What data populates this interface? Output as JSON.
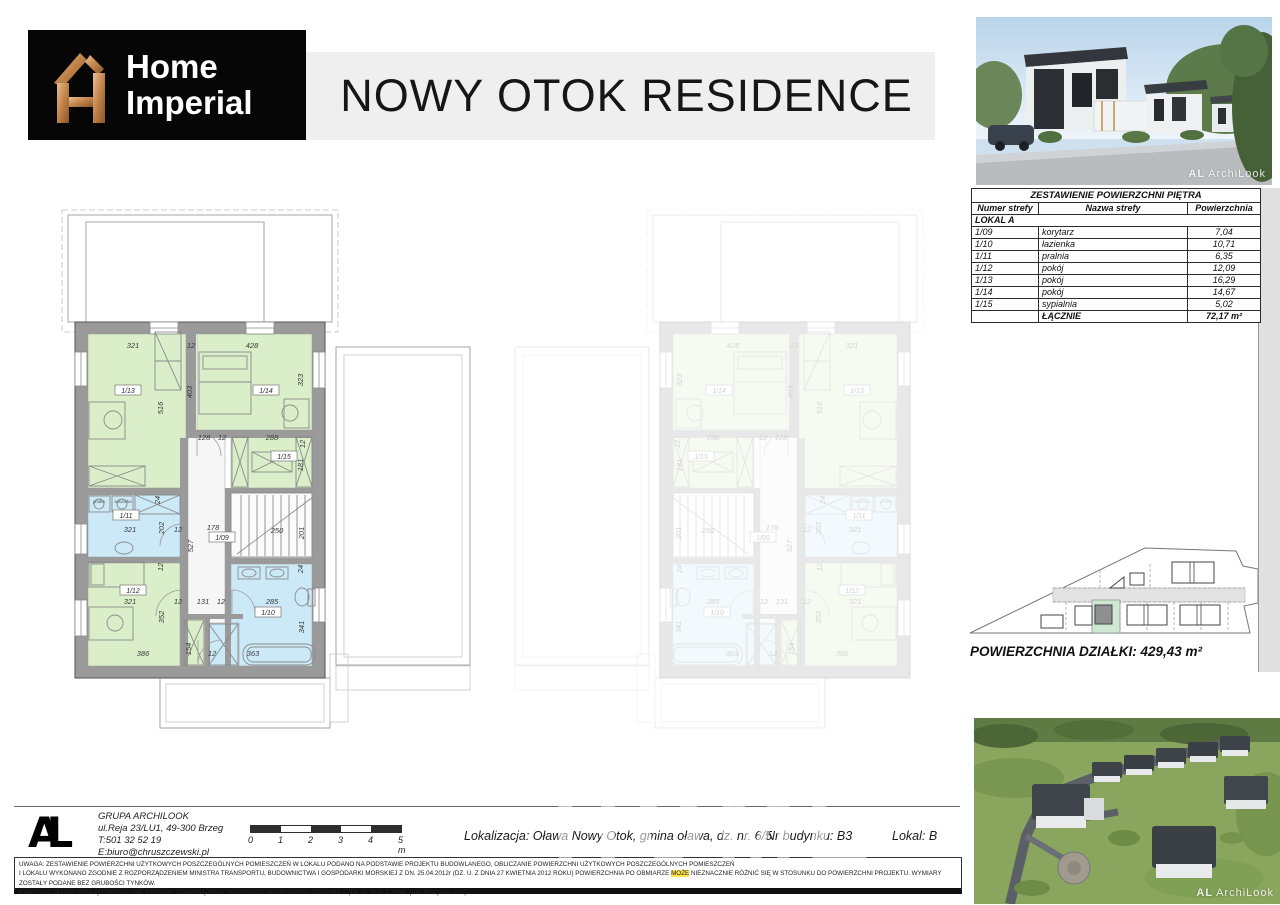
{
  "header": {
    "logo_line1": "Home",
    "logo_line2": "Imperial",
    "title": "NOWY OTOK RESIDENCE"
  },
  "photos": {
    "top_watermark_mark": "AL",
    "top_watermark_text": "ArchiLook",
    "bottom_watermark_mark": "AL",
    "bottom_watermark_text": "ArchiLook"
  },
  "area_table": {
    "title": "ZESTAWIENIE POWIERZCHNI PIĘTRA",
    "columns": [
      "Numer strefy",
      "Nazwa strefy",
      "Powierzchnia"
    ],
    "group_label": "LOKAL A",
    "rows": [
      [
        "1/09",
        "korytarz",
        "7,04"
      ],
      [
        "1/10",
        "łazienka",
        "10,71"
      ],
      [
        "1/11",
        "pralnia",
        "6,35"
      ],
      [
        "1/12",
        "pokój",
        "12,09"
      ],
      [
        "1/13",
        "pokój",
        "16,29"
      ],
      [
        "1/14",
        "pokój",
        "14,67"
      ],
      [
        "1/15",
        "sypialnia",
        "5,02"
      ]
    ],
    "total_label": "ŁĄCZNIE",
    "total_value": "72,17 m²"
  },
  "site_plan": {
    "area_label": "POWIERZCHNIA DZIAŁKI: 429,43 m²"
  },
  "floor_plan": {
    "rooms": [
      {
        "id": "1/13",
        "color": "green",
        "x": 88,
        "y": 334,
        "w": 98,
        "h": 154,
        "tx": 128,
        "ty": 392
      },
      {
        "id": "1/14",
        "color": "green",
        "x": 197,
        "y": 334,
        "w": 115,
        "h": 96,
        "tx": 266,
        "ty": 392
      },
      {
        "id": "1/15",
        "color": "green",
        "x": 231,
        "y": 436,
        "w": 81,
        "h": 52,
        "tx": 284,
        "ty": 458
      },
      {
        "id": "1/11",
        "color": "blue",
        "x": 88,
        "y": 495,
        "w": 92,
        "h": 62,
        "tx": 126,
        "ty": 517
      },
      {
        "id": "1/09",
        "color": "hall",
        "x": 188,
        "y": 436,
        "w": 37,
        "h": 230,
        "tx": 222,
        "ty": 539
      },
      {
        "id": "",
        "color": "hall2",
        "x": 231,
        "y": 493,
        "w": 81,
        "h": 65
      },
      {
        "id": "1/12",
        "color": "green",
        "x": 88,
        "y": 563,
        "w": 92,
        "h": 103,
        "tx": 133,
        "ty": 592
      },
      {
        "id": "1/10",
        "color": "blue",
        "x": 231,
        "y": 564,
        "w": 81,
        "h": 102,
        "tx": 268,
        "ty": 614
      },
      {
        "id": "",
        "color": "green",
        "x": 183,
        "y": 619,
        "w": 22,
        "h": 47
      },
      {
        "id": "",
        "color": "blue",
        "x": 209,
        "y": 623,
        "w": 30,
        "h": 43
      }
    ],
    "dims": [
      {
        "t": "321",
        "x": 133,
        "y": 348
      },
      {
        "t": "12",
        "x": 191,
        "y": 348
      },
      {
        "t": "428",
        "x": 252,
        "y": 348
      },
      {
        "t": "516",
        "x": 163,
        "y": 408,
        "v": 1
      },
      {
        "t": "403",
        "x": 192,
        "y": 392,
        "v": 1
      },
      {
        "t": "323",
        "x": 303,
        "y": 380,
        "v": 1
      },
      {
        "t": "128",
        "x": 204,
        "y": 440
      },
      {
        "t": "12",
        "x": 222,
        "y": 440
      },
      {
        "t": "288",
        "x": 272,
        "y": 440
      },
      {
        "t": "12",
        "x": 305,
        "y": 444,
        "v": 1
      },
      {
        "t": "181",
        "x": 303,
        "y": 465,
        "v": 1
      },
      {
        "t": "24",
        "x": 160,
        "y": 500,
        "v": 1
      },
      {
        "t": "321",
        "x": 130,
        "y": 532
      },
      {
        "t": "202",
        "x": 164,
        "y": 528,
        "v": 1
      },
      {
        "t": "12",
        "x": 178,
        "y": 532
      },
      {
        "t": "178",
        "x": 213,
        "y": 530
      },
      {
        "t": "527",
        "x": 193,
        "y": 546,
        "v": 1
      },
      {
        "t": "250",
        "x": 277,
        "y": 533
      },
      {
        "t": "201",
        "x": 304,
        "y": 533,
        "v": 1
      },
      {
        "t": "12",
        "x": 163,
        "y": 567,
        "v": 1
      },
      {
        "t": "24",
        "x": 303,
        "y": 569,
        "v": 1
      },
      {
        "t": "321",
        "x": 130,
        "y": 604
      },
      {
        "t": "352",
        "x": 164,
        "y": 617,
        "v": 1
      },
      {
        "t": "12",
        "x": 178,
        "y": 604
      },
      {
        "t": "131",
        "x": 203,
        "y": 604
      },
      {
        "t": "12",
        "x": 221,
        "y": 604
      },
      {
        "t": "285",
        "x": 272,
        "y": 604
      },
      {
        "t": "341",
        "x": 304,
        "y": 627,
        "v": 1
      },
      {
        "t": "386",
        "x": 143,
        "y": 656
      },
      {
        "t": "154",
        "x": 191,
        "y": 649,
        "v": 1
      },
      {
        "t": "12",
        "x": 212,
        "y": 656
      },
      {
        "t": "363",
        "x": 253,
        "y": 656
      }
    ],
    "appliances": [
      {
        "t": "pralka",
        "x": 99,
        "y": 503
      },
      {
        "t": "suszarka",
        "x": 123,
        "y": 503
      }
    ]
  },
  "footer": {
    "logo_mark": "AL",
    "company_name": "GRUPA ARCHILOOK",
    "company_address": "ul.Reja 23/LU1, 49-300 Brzeg",
    "company_phone": "T:501 32 52 19",
    "company_email": "E:biuro@chruszczewski.pl",
    "scale_ticks": [
      "0",
      "1",
      "2",
      "3",
      "4",
      "5 m"
    ],
    "location": "Lokalizacja: Oława Nowy Otok, gmina oława, dz. nr. 6/5",
    "building_no": "Nr budynku: B3",
    "unit": "Lokal: B"
  },
  "disclaimer": {
    "line1": "UWAGA: ZESTAWIENIE POWIERZCHNI UŻYTKOWYCH POSZCZEGÓLNYCH POMIESZCZEŃ W LOKALU PODANO NA PODSTAWIE PROJEKTU BUDOWLANEGO, OBLICZANIE POWIERZCHNI UŻYTKOWYCH POSZCZEGÓLNYCH POMIESZCZEŃ",
    "line2_pre": "I LOKALU WYKONANO ZGODNIE Z ROZPORZĄDZENIEM MINISTRA TRANSPORTU, BUDOWNICTWA I GOSPODARKI MORSKIEJ Z DN. 25.04.2012r (DZ. U. Z DNIA 27 KWIETNIA 2012 ROKU) POWIERZCHNIA PO OBMIARZE ",
    "line2_highlight": "MOŻE",
    "line2_post": " NIEZNACZNIE RÓŻNIĆ SIĘ W STOSUNKU DO POWIERZCHNI PROJEKTU. WYMIARY ZOSTAŁY PODANE BEZ GRUBOŚCI TYNKÓW.",
    "line3": "KARTA DO CELÓW POGLĄDOWYCH - NIE STANOWI ZOBOWIĄZANIA UMOWNEGO DEWELOPERA ZGODNIE Z (Dz. U. Nr16 Z 1964r. poz. 93 z późn. zm.)"
  },
  "watermark_ghost": "HOME",
  "colors": {
    "room_green": "#daeec9",
    "room_blue": "#cbe9f7",
    "wall_gray": "#9a9a9a",
    "highlight_parcel": "#cfe8d2",
    "logo_copper": "#c98e5f"
  }
}
